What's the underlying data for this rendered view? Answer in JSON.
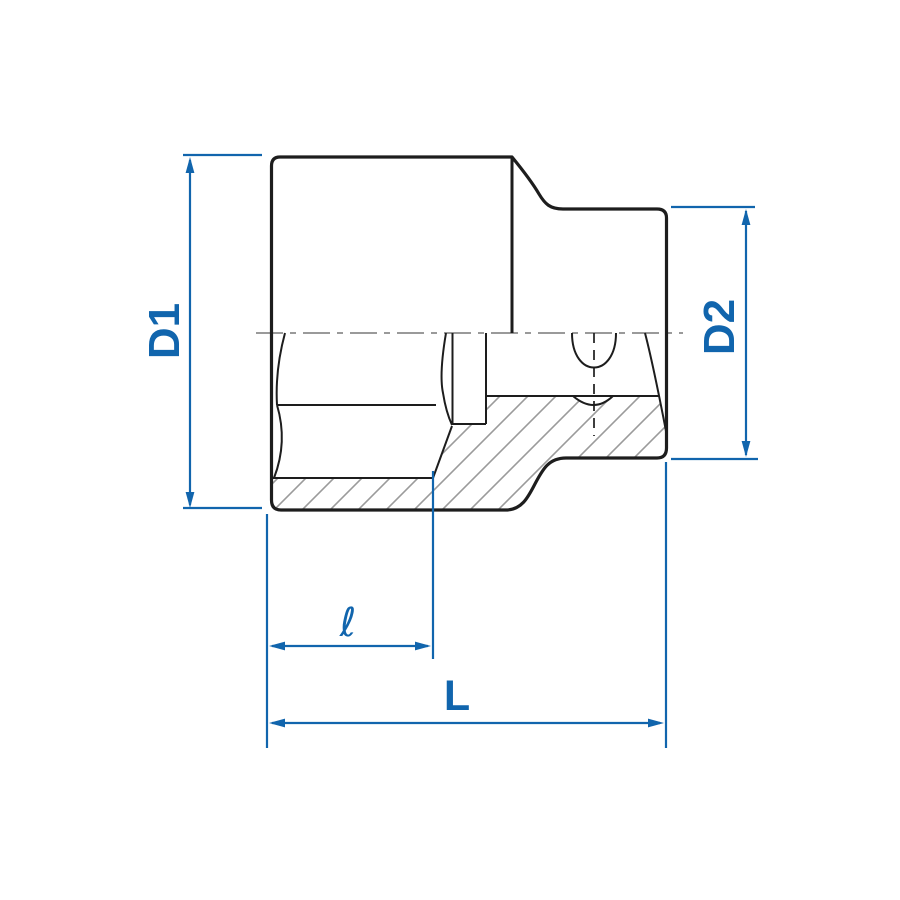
{
  "drawing": {
    "title": "socket cross-section dimension diagram",
    "view": "half-section side view of hex drive socket",
    "dimensions": {
      "d1_label": "D1",
      "d2_label": "D2",
      "inner_depth_label": "ℓ",
      "overall_length_label": "L"
    },
    "colors": {
      "dimension_blue": "#1165ad",
      "outline_black": "#1d1d1d",
      "hatch_gray": "#9b9b9b",
      "centerline_gray": "#8c8c8c",
      "background": "#ffffff"
    }
  }
}
